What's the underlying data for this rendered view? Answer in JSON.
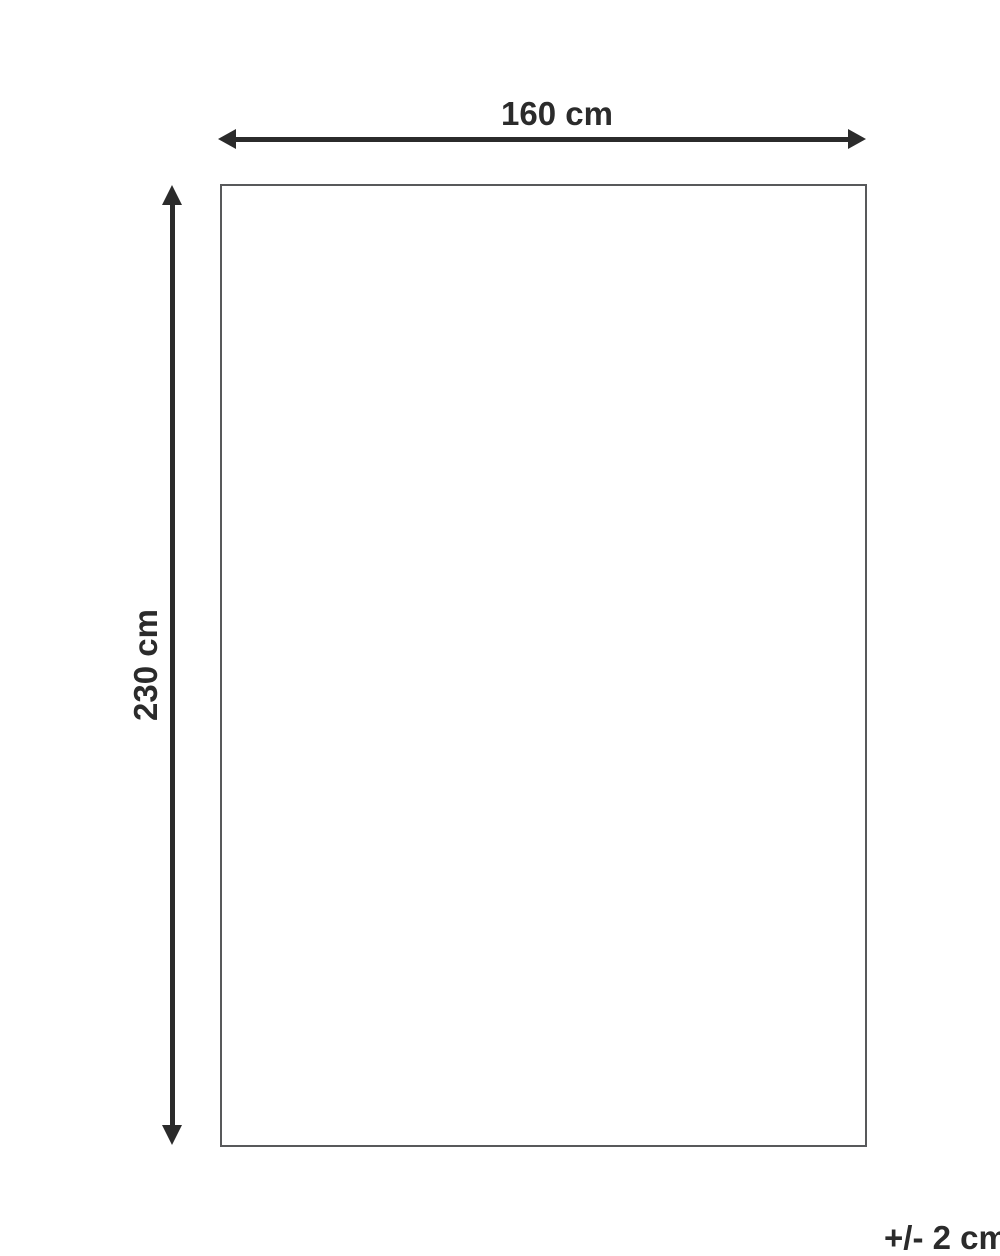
{
  "diagram": {
    "type": "product-dimension-diagram",
    "width_label": "160 cm",
    "height_label": "230 cm",
    "tolerance_label": "+/- 2 cm"
  },
  "colors": {
    "ink": "#2b2b2b",
    "rect_border": "#58595b",
    "background": "#ffffff"
  }
}
